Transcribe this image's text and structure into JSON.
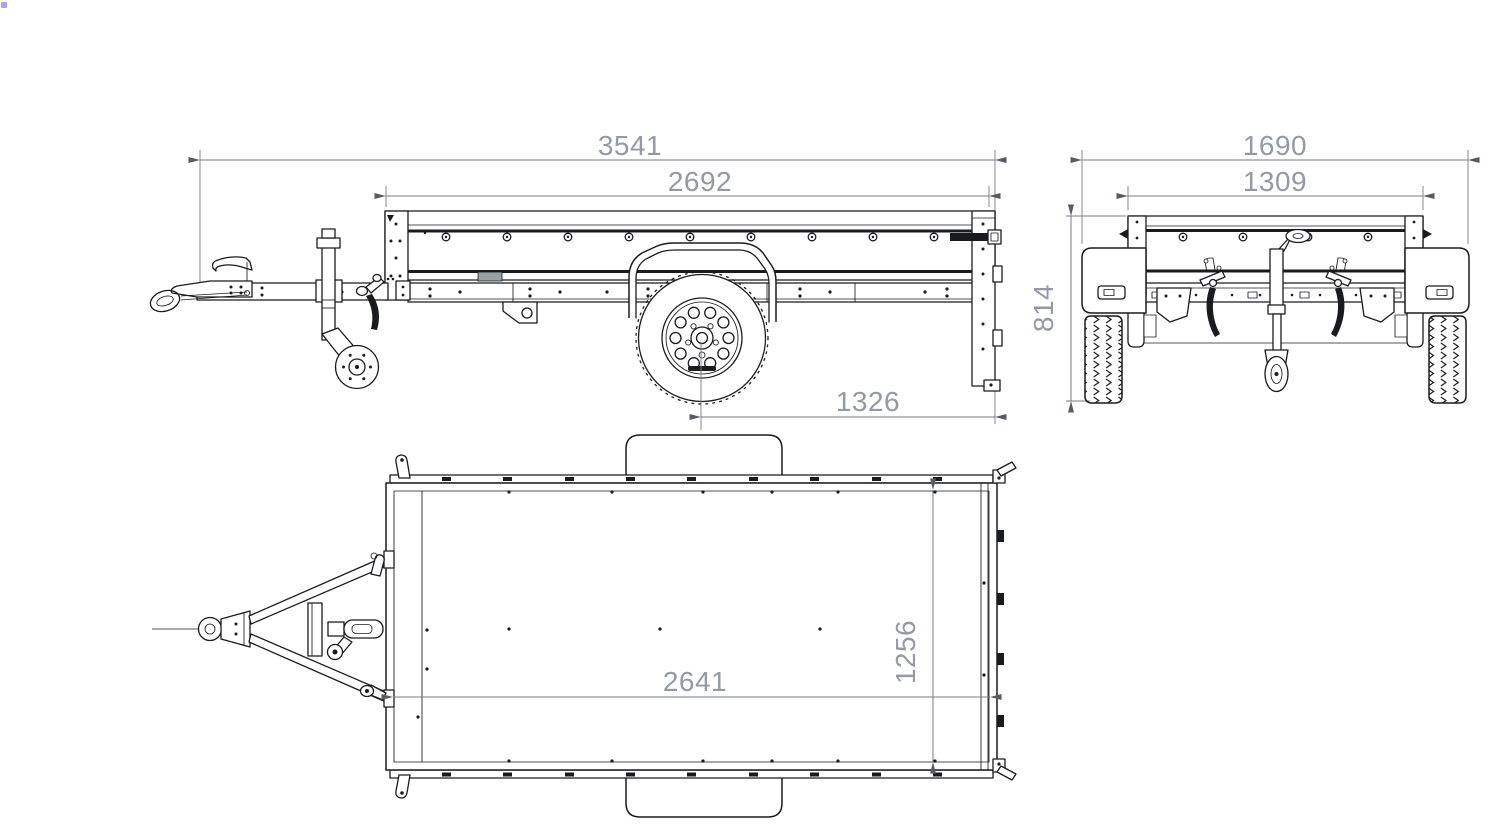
{
  "drawing": {
    "title_hint": "trailer three-view dimension drawing",
    "colors": {
      "line": "#1a1b1f",
      "dim_line": "#767b85",
      "dim_arrow": "#565b64",
      "dim_text": "#939aa4",
      "background": "#ffffff",
      "cursor_dot": "#8886f2"
    },
    "views": {
      "side": {
        "dims": {
          "overall_length": "3541",
          "box_length": "2692",
          "axle_to_rear": "1326"
        }
      },
      "rear": {
        "dims": {
          "overall_width": "1690",
          "box_width": "1309",
          "overall_height": "814"
        }
      },
      "top": {
        "dims": {
          "bed_length": "2641",
          "bed_width": "1256"
        }
      }
    }
  }
}
